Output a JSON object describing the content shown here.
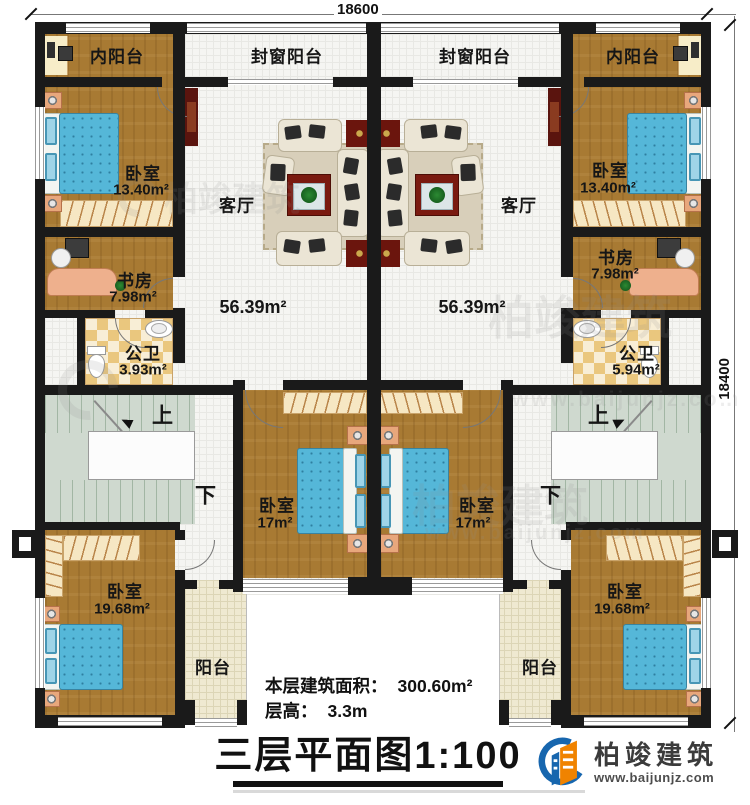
{
  "dimensions": {
    "top": "18600",
    "right": "18400"
  },
  "labels": {
    "inner_balcony": "内阳台",
    "sealed_balcony": "封窗阳台",
    "bedroom": "卧室",
    "living_room": "客厅",
    "study": "书房",
    "bathroom": "公卫",
    "balcony": "阳台",
    "stairs_up": "上",
    "stairs_down": "下"
  },
  "areas": {
    "bedroom_top": "13.40m²",
    "living_room": "56.39m²",
    "study": "7.98m²",
    "bathroom_left": "3.93m²",
    "bathroom_right": "5.94m²",
    "bedroom_middle": "17m²",
    "bedroom_bottom": "19.68m²"
  },
  "footer": {
    "floor_area_label": "本层建筑面积：",
    "floor_area_value": "300.60m²",
    "floor_height_label": "层高：",
    "floor_height_value": "3.3m",
    "title": "三层平面图1:100"
  },
  "brand": {
    "name": "柏竣建筑",
    "website": "www.baijunjz.com"
  },
  "colors": {
    "wall": "#1a1a1a",
    "wood_floor": "#a87a33",
    "bed": "#55b7d8",
    "checker_tile": "#eac77e",
    "brand_blue": "#1766ae",
    "brand_orange": "#f08300"
  }
}
